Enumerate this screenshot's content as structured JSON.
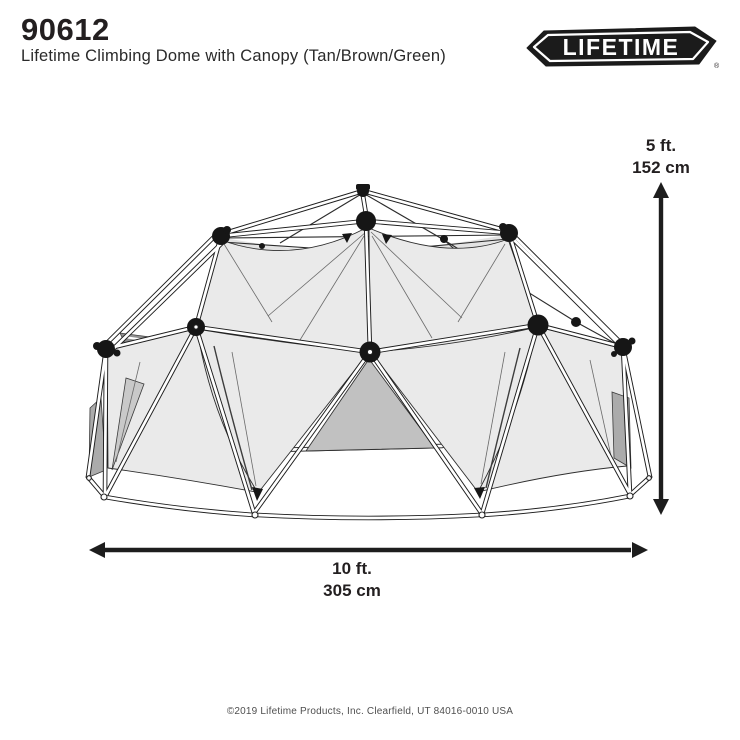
{
  "header": {
    "product_number": "90612",
    "product_title": "Lifetime Climbing Dome with Canopy (Tan/Brown/Green)"
  },
  "logo": {
    "brand": "LIFETIME",
    "registered": "®"
  },
  "dimensions": {
    "height": {
      "imperial": "5 ft.",
      "metric": "152 cm"
    },
    "width": {
      "imperial": "10 ft.",
      "metric": "305 cm"
    }
  },
  "footer": {
    "copyright": "©2019 Lifetime Products, Inc. Clearfield, UT 84016-0010 USA"
  },
  "illustration": {
    "description": "Line drawing of a geodesic climbing dome with triangular canopy panels and black hub connectors",
    "colors": {
      "ink": "#231f20",
      "canopy_light": "#eaeaea",
      "canopy_mid": "#c9c9c9",
      "canopy_dark": "#ababab",
      "background": "#ffffff"
    }
  }
}
